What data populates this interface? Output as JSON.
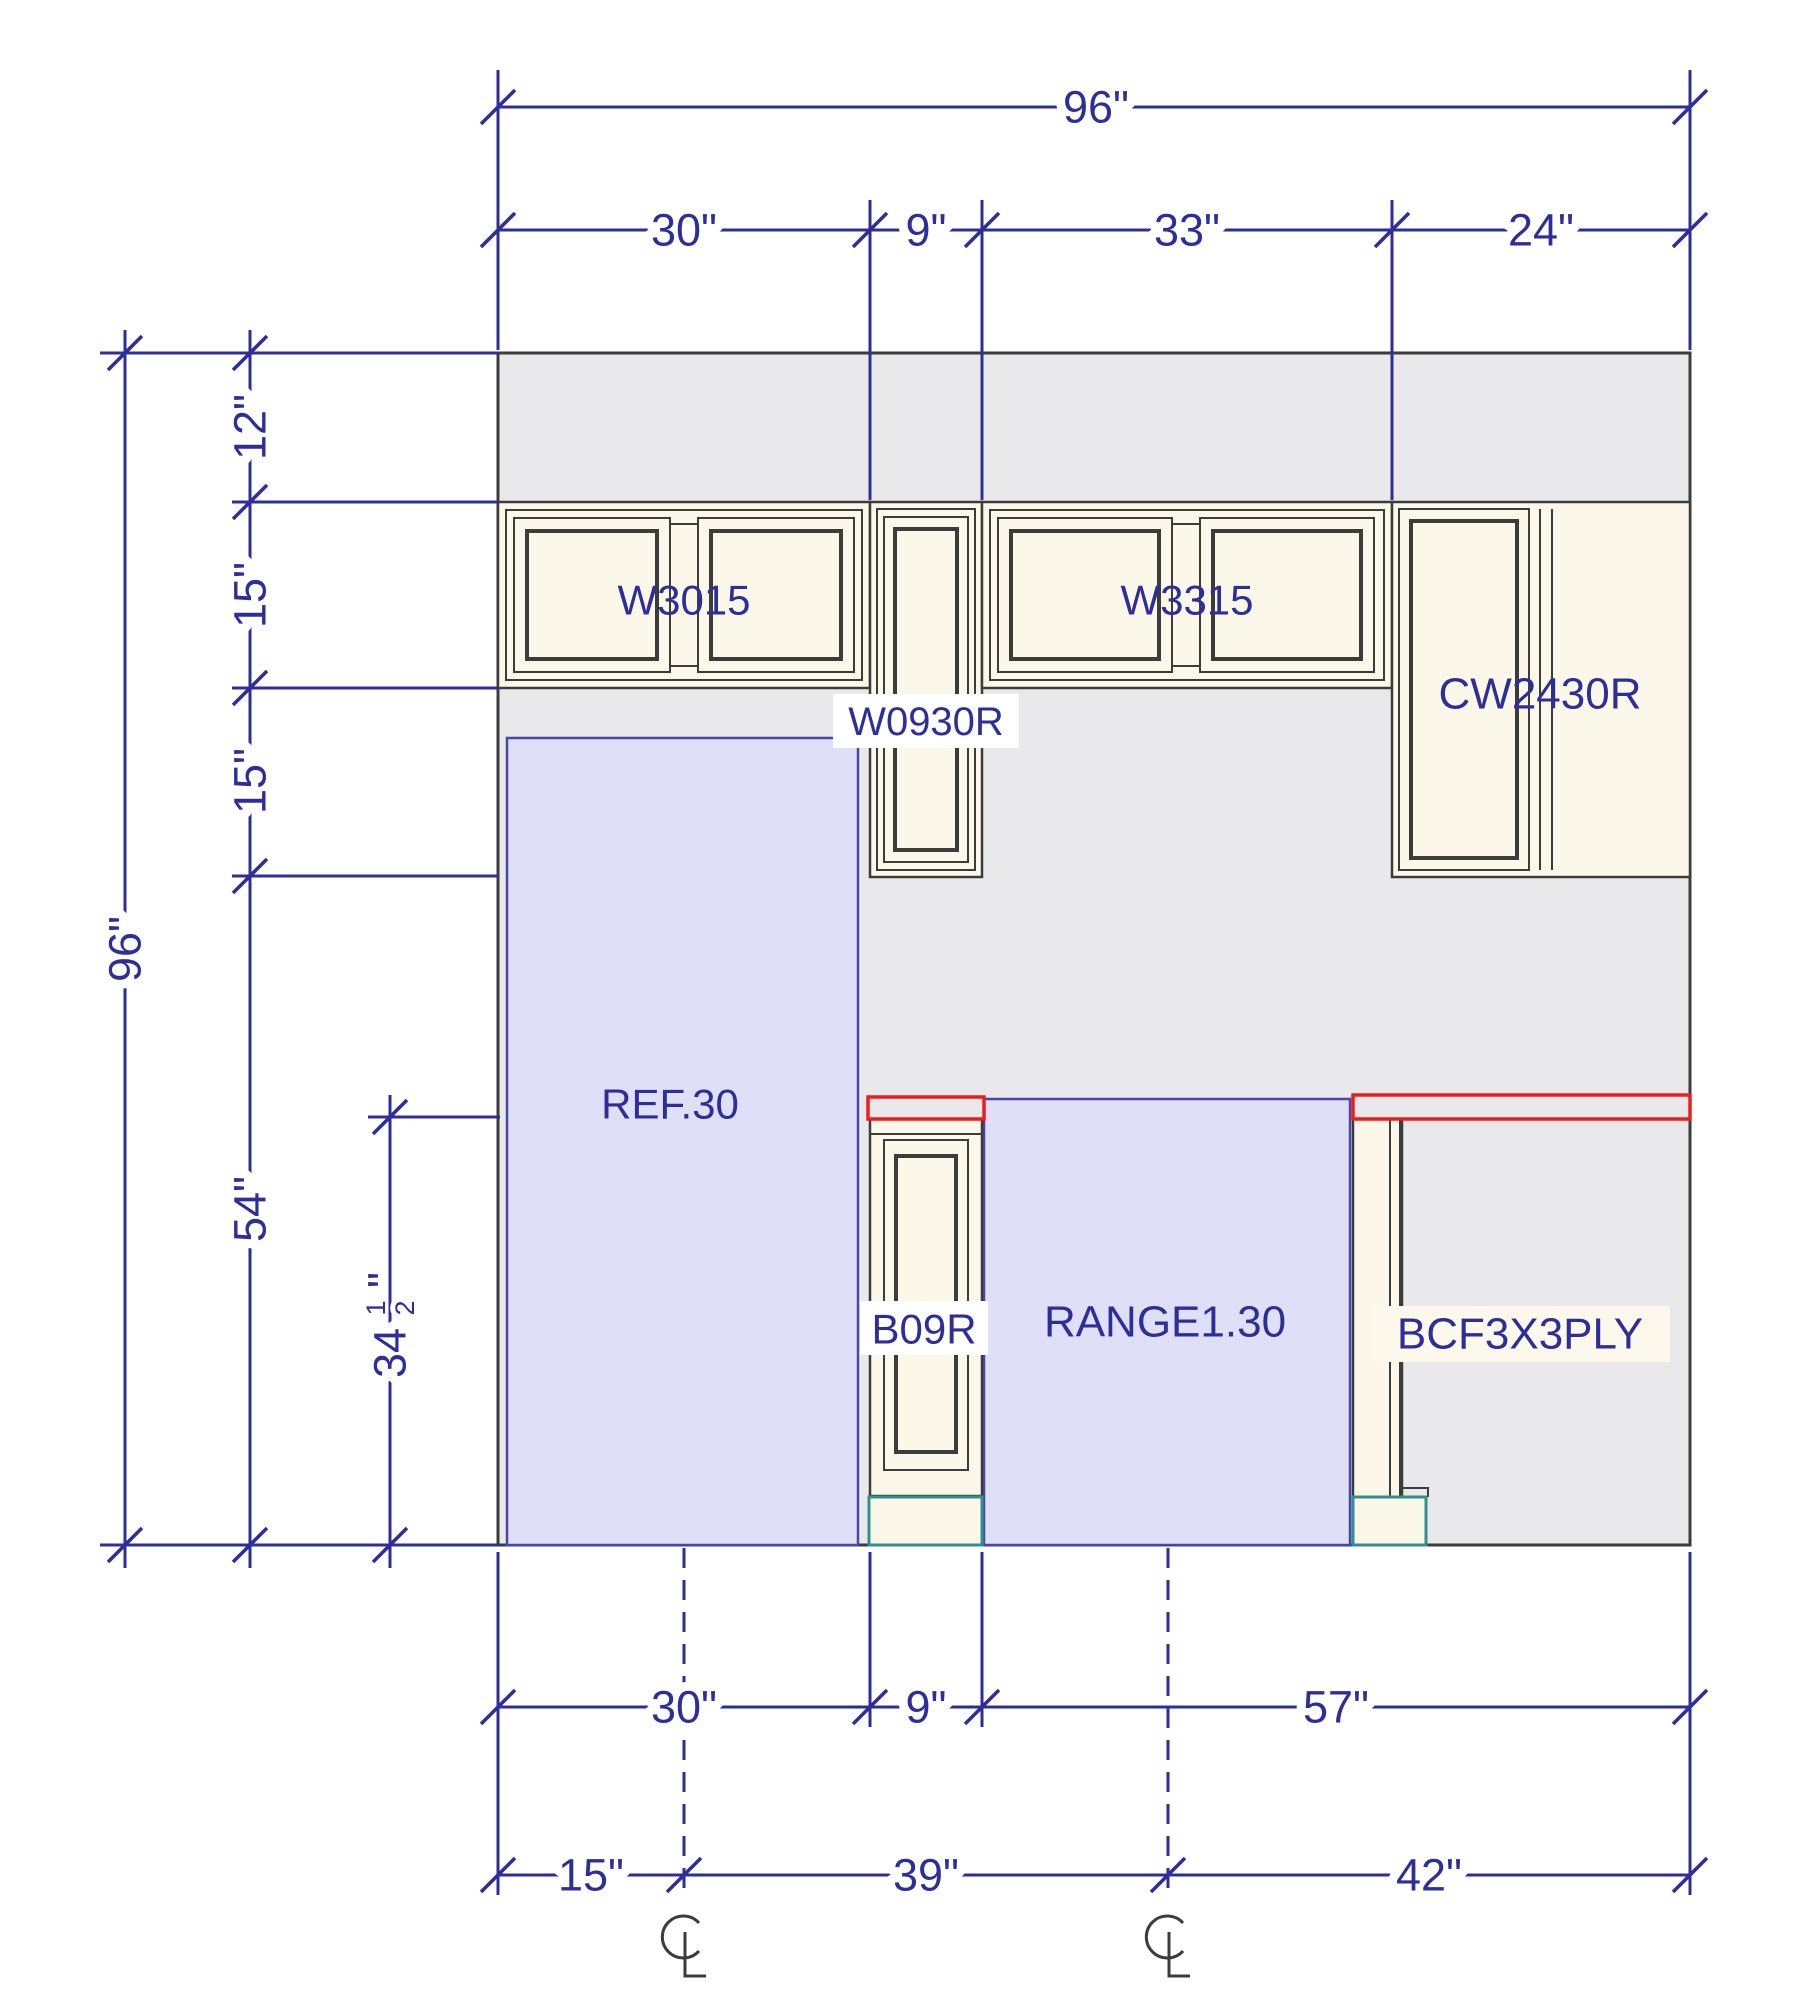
{
  "title": "Kitchen wall elevation drawing",
  "colors": {
    "navy": "#2e2e99",
    "wall": "#e9e9ec",
    "cream": "#fbf8ea",
    "lav": "#dfdff8",
    "lavb": "#4848a8",
    "dark": "#3c3c3a",
    "red": "#ee1d1d",
    "teal": "#2f9090",
    "labelbg": "#ffffff"
  },
  "labels": {
    "w3015": "W3015",
    "w0930r": "W0930R",
    "w3315": "W3315",
    "cw2430r": "CW2430R",
    "ref": "REF.30",
    "b09r": "B09R",
    "range": "RANGE1.30",
    "bcf": "BCF3X3PLY"
  },
  "dimensions": {
    "top": {
      "total": "96\"",
      "segments": [
        "30\"",
        "9\"",
        "33\"",
        "24\""
      ]
    },
    "left": {
      "overall": "96\"",
      "soffit": "12\"",
      "wall_cab_upper": "15\"",
      "wall_cab_lower": "15\"",
      "to_floor": "54\"",
      "base_height": {
        "whole": "34",
        "num": "1",
        "den": "2",
        "unit": "\""
      }
    },
    "bottom_row1": [
      "30\"",
      "9\"",
      "57\""
    ],
    "bottom_row2": [
      "15\"",
      "39\"",
      "42\""
    ]
  }
}
